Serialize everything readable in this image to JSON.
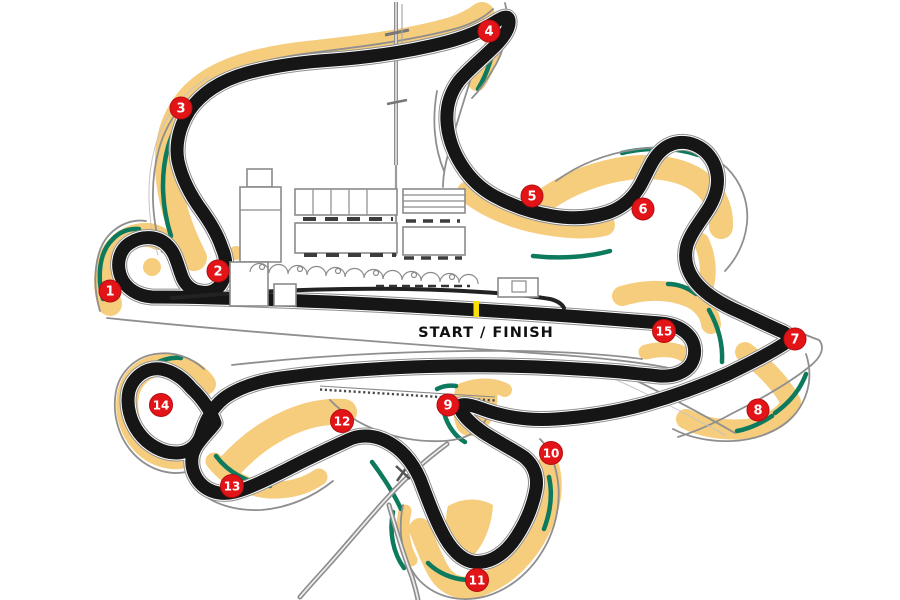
{
  "labels": {
    "start_finish": "START / FINISH"
  },
  "corners": [
    "1",
    "2",
    "3",
    "4",
    "5",
    "6",
    "7",
    "8",
    "9",
    "10",
    "11",
    "12",
    "13",
    "14",
    "15"
  ],
  "colors": {
    "track": "#161616",
    "runoff_sand": "#f6cd7d",
    "verge_green": "#0d7a5e",
    "marker_red": "#e31418",
    "fence_grey": "#8f8f8f",
    "start_line_yellow": "#f6e005",
    "background": "#ffffff"
  }
}
